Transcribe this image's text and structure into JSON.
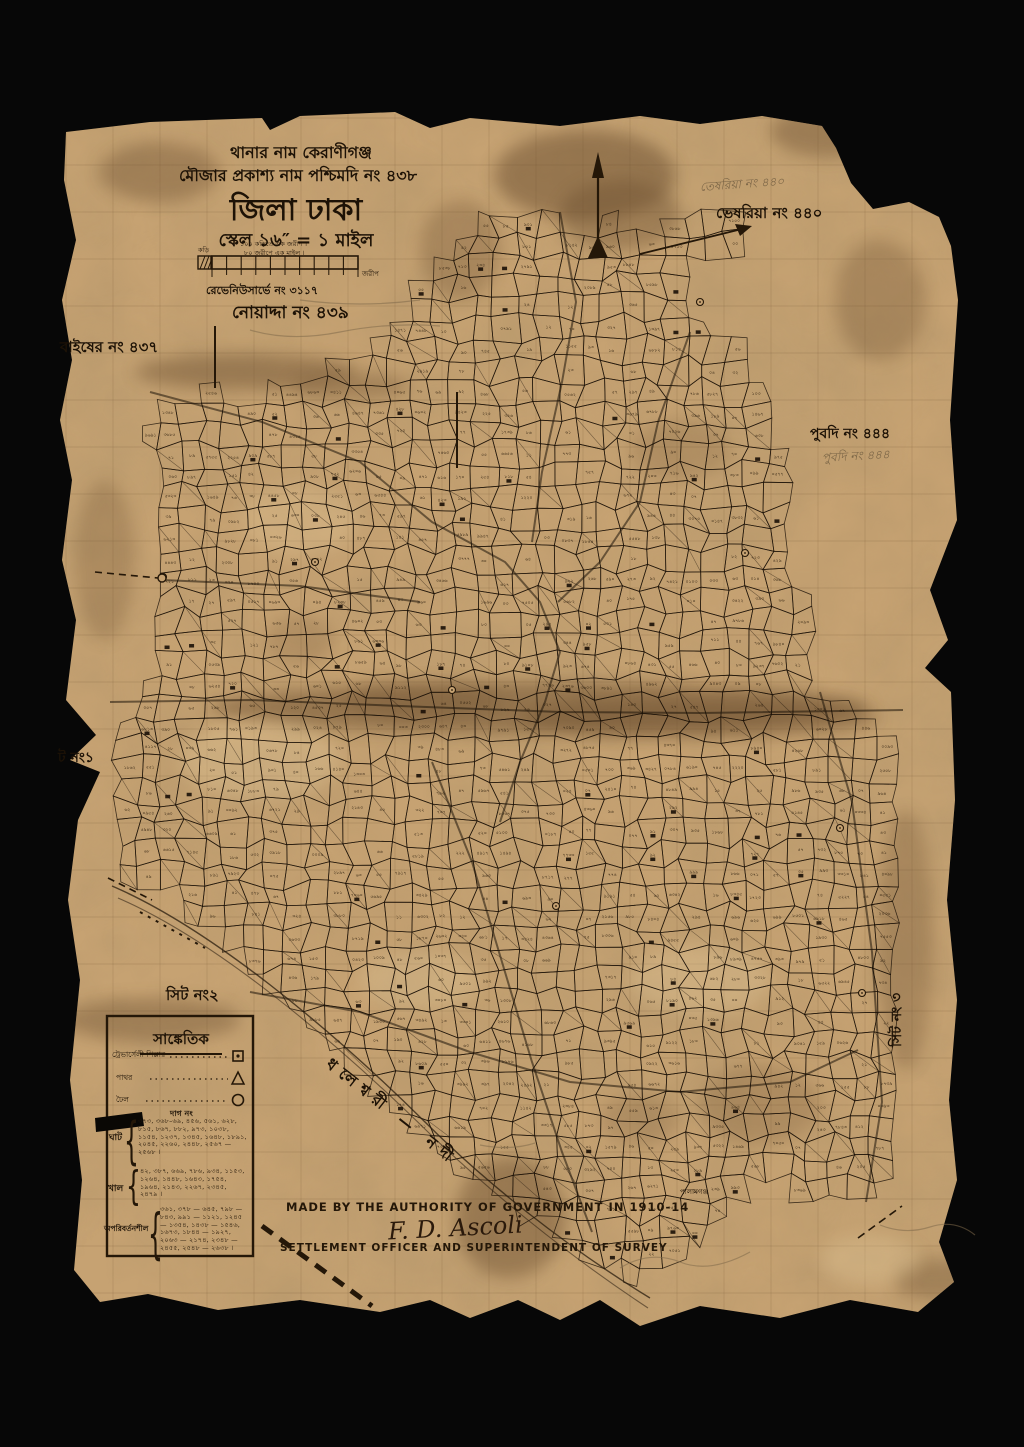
{
  "page": {
    "background": "#070707",
    "paper_color": "#c6a272",
    "ink_color": "#241708",
    "pencil_color": "#705c40"
  },
  "title_block": {
    "thana_line": "থানার নাম কেরাণীগঞ্জ",
    "mouza_line": "মৌজার প্রকাশ্য নাম পশ্চিমদি নং ৪৩৮",
    "district": "জিলা ঢাকা",
    "scale_line": "স্কেল ১৬″ = ১ মাইল",
    "scale_note1": "১০০ কড়িতে এক জরীপ ।",
    "scale_note2": "৮০ জরীপে এক মাইল ।",
    "scale_left_label": "কড়ি",
    "scale_right_label": "জরীপ",
    "survey_no": "রেভেনিউসার্ভে নং ৩১১৭"
  },
  "neighbors": {
    "top_right": "ভেষরিয়া নং ৪৪০",
    "top_right_pencil": "তেষরিয়া নং ৪৪০",
    "upper_left": "নোয়াদ্দা নং ৪৩৯",
    "left": "বাইষের নং ৪৩৭",
    "right": "পুবদি নং ৪৪৪",
    "right_pencil": "পুবদি নং ৪৪৪",
    "sheet1": "ট নং১",
    "sheet2": "সিট নং২",
    "sheet3": "সিট নং ৩",
    "river": "ধলেশ্বরী — নদী",
    "village": "পালামগঞ্জ"
  },
  "legend": {
    "title": "সাঙ্কেতিক",
    "rows": [
      {
        "label": "ট্রেভার্সেলী পিল্লার",
        "symbol": "square-icon"
      },
      {
        "label": "পাথর",
        "symbol": "triangle-icon"
      },
      {
        "label": "ঢৈল",
        "symbol": "circle-icon"
      }
    ],
    "dag_heading": "দাগ নং",
    "groups": [
      {
        "name": "ঘাট",
        "numbers": "৩৭৩, ৩৬৮–৬৯, ৪৫৬, ৫৬১, ৬২৮, ৮১৫, ৮৬৭, ৮৮২, ৯৭৩, ১০৩৮, ১১৫৪, ১২৩৭, ১৩৪৫, ১৬৪৮, ১৮৯১, ২০৪৫, ২২৬০, ২৪৪৮, ২৫৬৭ — ২৫৬৮ ।"
      },
      {
        "name": "খাল",
        "numbers": "৪২, ৩৮৭, ৬৬৯, ৭৮৬, ৯৩৪, ১১৫৩, ১২৬৪, ১৪৪৮, ১৬৪৩, ১৭৫৪, ১৯৬৪, ২১৪৩, ২২৬৭, ২৩৪৫, ২৪৭৯ ।"
      },
      {
        "name": "অপরিবর্তনশীল",
        "numbers": "৩৬১, ৩৭৮ — ৬৪৫, ৭৯৮ — ৮৪৩, ৯৯১ — ১১২১, ১২৪৫ — ১৩৫৪, ১৪৩৮ — ১৫৪৬, ১৬৭৩, ১৮৪৪ — ১৯২৭, ২০৬৩ — ২১৭৪, ২৩৪৮ — ২৪৫৫, ২৫৪৮ — ২৬৩৮ ।"
      }
    ]
  },
  "footer": {
    "authority_line": "MADE BY THE AUTHORITY OF GOVERNMENT IN 1910-14",
    "signature": "F. D. Ascoli",
    "officer_line": "SETTLEMENT OFFICER AND SUPERINTENDENT OF SURVEY"
  },
  "map": {
    "digits": "০১২৩৪৫৬৭৮৯"
  }
}
